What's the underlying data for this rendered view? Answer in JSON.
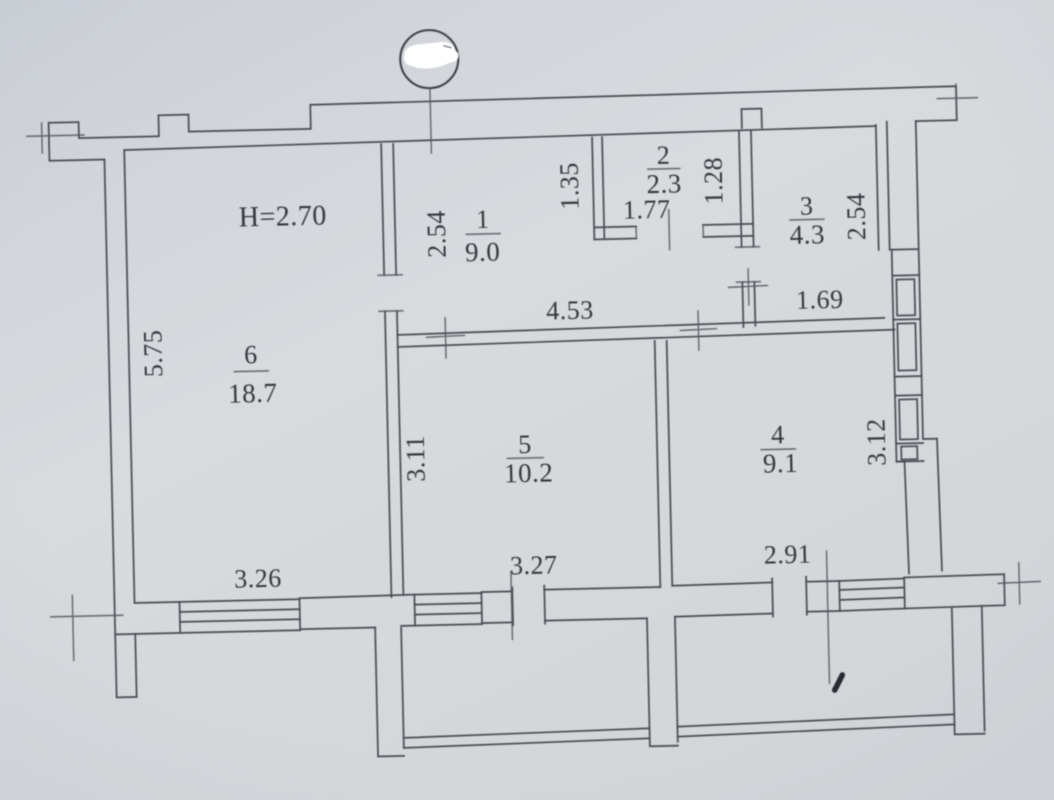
{
  "plan": {
    "ceiling_height": "H=2.70",
    "rooms": [
      {
        "number": "1",
        "area": "9.0"
      },
      {
        "number": "2",
        "area": "2.3"
      },
      {
        "number": "3",
        "area": "4.3"
      },
      {
        "number": "4",
        "area": "9.1"
      },
      {
        "number": "5",
        "area": "10.2"
      },
      {
        "number": "6",
        "area": "18.7"
      }
    ],
    "dimensions": {
      "room6_height": "5.75",
      "room6_width": "3.26",
      "room5_width": "3.27",
      "room5_height": "3.11",
      "room4_width": "2.91",
      "room4_height": "3.12",
      "room1_depth": "2.54",
      "hall_top_width": "4.53",
      "room2_left_height": "1.35",
      "room2_width": "1.77",
      "room2_right_height": "1.28",
      "room3_height": "2.54",
      "room3_bottom_width": "1.69"
    }
  }
}
